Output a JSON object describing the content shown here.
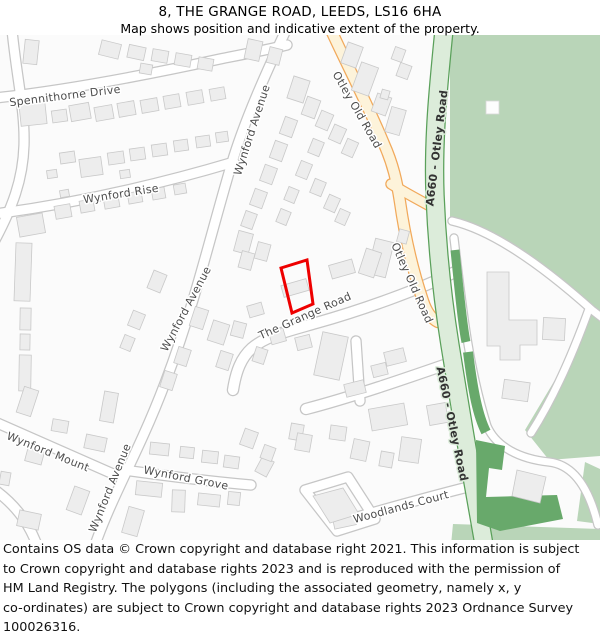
{
  "title": {
    "line1": "8, THE GRANGE ROAD, LEEDS, LS16 6HA",
    "line2": "Map shows position and indicative extent of the property."
  },
  "footer": {
    "lines": [
      "Contains OS data © Crown copyright and database right 2021. This information is subject",
      "to Crown copyright and database rights 2023 and is reproduced with the permission of",
      "HM Land Registry. The polygons (including the associated geometry, namely x, y",
      "co-ordinates) are subject to Crown copyright and database rights 2023 Ordnance Survey",
      "100026316."
    ]
  },
  "map": {
    "colors": {
      "bg": "#fbfbfb",
      "building_fill": "#ededed",
      "building_stroke": "#c9c9c9",
      "road_casing": "#c6c6c6",
      "road_fill": "#ffffff",
      "yellow_road_fill": "#fdf3da",
      "yellow_road_casing": "#f1a95b",
      "green_road_fill": "#dcecda",
      "green_road_casing": "#5aa05a",
      "green_light": "#b9d5b8",
      "green_dark": "#68a96b",
      "label_color": "#4c4c4c",
      "a_road_label_color": "#333333",
      "plot_color": "#ee0000",
      "white_building_fill": "#fdfdfd"
    },
    "green_light_areas": [
      "450,35 600,35 600,316 588,306 552,274 518,248 488,230 450,218",
      "590,312 600,322 600,456 549,460 525,430 571,353",
      "453,524 600,529 600,545 451,545",
      "585,462 600,469 600,524 577,521"
    ],
    "dark_green_paths": [
      {
        "d": "M 455,250 C 460,300 463,328 466,342",
        "w": 9
      },
      {
        "d": "M 468,352 C 473,392 478,416 486,432",
        "w": 10
      }
    ],
    "dark_green_polys": [
      "476,440 505,446 502,470 489,468 486,497 557,495 563,519 500,531 477,523"
    ],
    "roads": [
      {
        "d": "M 12,30 C 17,80 25,110 24,145 C 23,180 12,208 -5,240",
        "w": 9,
        "layer": "minor"
      },
      {
        "d": "M -5,98 C 70,90 160,72 220,59 C 245,54 266,50 287,45",
        "w": 9,
        "layer": "minor"
      },
      {
        "d": "M 286,30 C 265,75 246,118 234,156 C 221,198 208,250 193,300 C 179,347 163,392 143,436 C 125,476 108,508 95,545",
        "w": 9,
        "layer": "minor"
      },
      {
        "d": "M -5,214 C 70,204 150,187 234,162",
        "w": 9,
        "layer": "minor"
      },
      {
        "d": "M 233,390 C 236,371 241,358 252,348 C 266,336 288,331 316,323 C 366,309 420,289 455,272",
        "w": 10,
        "layer": "minor"
      },
      {
        "d": "M 306,409 C 352,397 404,379 453,362",
        "w": 10,
        "layer": "minor"
      },
      {
        "d": "M 356,341 L 360,401",
        "w": 9,
        "layer": "minor"
      },
      {
        "d": "M -5,422 C 40,442 85,462 120,477",
        "w": 9,
        "layer": "minor"
      },
      {
        "d": "M 124,470 C 160,475 205,481 251,485",
        "w": 9,
        "layer": "minor"
      },
      {
        "d": "M 332,524 C 372,513 420,499 468,487",
        "w": 9,
        "layer": "minor"
      },
      {
        "d": "M 305,490 L 348,477 L 375,519 L 337,531 Z",
        "w": 9,
        "layer": "minor"
      },
      {
        "d": "M -5,490 C 14,504 28,521 37,545",
        "w": 9,
        "layer": "minor"
      },
      {
        "d": "M 452,221 C 495,231 545,268 592,310 L 605,320",
        "w": 7,
        "layer": "minor"
      },
      {
        "d": "M 454,238 C 462,305 468,365 487,426 C 496,447 520,459 549,462 C 576,465 590,492 598,525",
        "w": 7,
        "layer": "minor"
      },
      {
        "d": "M 589,309 C 576,345 556,394 531,433",
        "w": 7,
        "layer": "minor"
      },
      {
        "d": "M 331,30 C 347,65 368,105 384,144 C 393,164 397,182 400,202 C 405,237 413,271 423,301 C 427,313 432,319 438,322",
        "w": 10,
        "layer": "yellow"
      },
      {
        "d": "M 391,184 C 404,192 417,199 430,206",
        "w": 9,
        "layer": "yellow"
      },
      {
        "d": "M 444,30 C 438,90 433,140 435,195 C 437,245 442,295 450,345 C 457,388 465,438 474,488 C 478,510 481,527 484,545",
        "w": 17,
        "layer": "green"
      }
    ],
    "buildings": [
      [
        24,
        40,
        14,
        24,
        6
      ],
      [
        100,
        42,
        20,
        15,
        14
      ],
      [
        128,
        46,
        17,
        13,
        12
      ],
      [
        152,
        50,
        16,
        12,
        10
      ],
      [
        175,
        54,
        16,
        12,
        10
      ],
      [
        198,
        58,
        15,
        12,
        10
      ],
      [
        140,
        64,
        12,
        10,
        10
      ],
      [
        246,
        40,
        15,
        20,
        12
      ],
      [
        268,
        48,
        13,
        16,
        14
      ],
      [
        20,
        103,
        26,
        22,
        -6
      ],
      [
        52,
        110,
        15,
        12,
        -8
      ],
      [
        70,
        104,
        20,
        16,
        -10
      ],
      [
        95,
        106,
        18,
        14,
        -10
      ],
      [
        118,
        102,
        17,
        14,
        -10
      ],
      [
        141,
        99,
        17,
        13,
        -10
      ],
      [
        164,
        95,
        16,
        13,
        -10
      ],
      [
        187,
        91,
        16,
        13,
        -10
      ],
      [
        210,
        88,
        15,
        12,
        -10
      ],
      [
        60,
        152,
        15,
        11,
        -8
      ],
      [
        47,
        170,
        10,
        8,
        -8
      ],
      [
        80,
        158,
        22,
        18,
        -8
      ],
      [
        108,
        152,
        16,
        12,
        -8
      ],
      [
        130,
        148,
        15,
        12,
        -8
      ],
      [
        152,
        144,
        15,
        12,
        -8
      ],
      [
        174,
        140,
        14,
        11,
        -8
      ],
      [
        196,
        136,
        14,
        11,
        -8
      ],
      [
        216,
        132,
        12,
        10,
        -8
      ],
      [
        120,
        170,
        10,
        8,
        -8
      ],
      [
        18,
        215,
        26,
        20,
        -10
      ],
      [
        55,
        205,
        16,
        13,
        -10
      ],
      [
        80,
        200,
        14,
        12,
        -10
      ],
      [
        104,
        196,
        15,
        12,
        -10
      ],
      [
        128,
        192,
        14,
        11,
        -10
      ],
      [
        152,
        188,
        13,
        11,
        -10
      ],
      [
        174,
        184,
        12,
        10,
        -10
      ],
      [
        60,
        190,
        9,
        7,
        -10
      ],
      [
        15,
        243,
        16,
        58,
        2
      ],
      [
        20,
        308,
        11,
        22,
        1
      ],
      [
        20,
        334,
        10,
        16,
        1
      ],
      [
        19,
        355,
        12,
        36,
        1
      ],
      [
        150,
        272,
        14,
        19,
        22
      ],
      [
        130,
        312,
        13,
        16,
        22
      ],
      [
        122,
        336,
        11,
        14,
        22
      ],
      [
        192,
        308,
        14,
        20,
        18
      ],
      [
        210,
        322,
        17,
        21,
        18
      ],
      [
        218,
        352,
        13,
        17,
        18
      ],
      [
        176,
        348,
        13,
        17,
        18
      ],
      [
        162,
        372,
        13,
        17,
        18
      ],
      [
        290,
        78,
        17,
        23,
        18
      ],
      [
        304,
        98,
        14,
        19,
        20
      ],
      [
        282,
        118,
        13,
        18,
        20
      ],
      [
        272,
        142,
        13,
        18,
        20
      ],
      [
        262,
        166,
        13,
        17,
        20
      ],
      [
        252,
        190,
        13,
        17,
        20
      ],
      [
        243,
        212,
        12,
        16,
        20
      ],
      [
        318,
        112,
        13,
        17,
        23
      ],
      [
        331,
        126,
        13,
        16,
        24
      ],
      [
        344,
        140,
        12,
        16,
        24
      ],
      [
        310,
        140,
        12,
        15,
        22
      ],
      [
        298,
        162,
        12,
        16,
        22
      ],
      [
        312,
        180,
        12,
        15,
        22
      ],
      [
        326,
        196,
        12,
        15,
        24
      ],
      [
        337,
        210,
        11,
        14,
        24
      ],
      [
        286,
        188,
        11,
        14,
        22
      ],
      [
        278,
        210,
        11,
        14,
        22
      ],
      [
        344,
        44,
        16,
        22,
        20
      ],
      [
        356,
        64,
        18,
        30,
        20
      ],
      [
        374,
        95,
        15,
        19,
        20
      ],
      [
        393,
        48,
        11,
        13,
        20
      ],
      [
        398,
        64,
        12,
        14,
        20
      ],
      [
        388,
        108,
        15,
        26,
        16
      ],
      [
        381,
        90,
        8,
        9,
        16
      ],
      [
        371,
        240,
        19,
        36,
        14
      ],
      [
        398,
        230,
        10,
        13,
        15
      ],
      [
        236,
        232,
        15,
        21,
        15
      ],
      [
        256,
        243,
        13,
        17,
        15
      ],
      [
        330,
        262,
        24,
        14,
        -16
      ],
      [
        362,
        250,
        16,
        26,
        18
      ],
      [
        282,
        282,
        26,
        12,
        -16
      ],
      [
        240,
        252,
        13,
        17,
        15
      ],
      [
        248,
        304,
        15,
        12,
        -16
      ],
      [
        232,
        322,
        13,
        15,
        15
      ],
      [
        270,
        330,
        15,
        13,
        -16
      ],
      [
        318,
        334,
        26,
        44,
        12
      ],
      [
        296,
        336,
        15,
        13,
        -14
      ],
      [
        254,
        348,
        12,
        15,
        18
      ],
      [
        290,
        424,
        13,
        16,
        10
      ],
      [
        345,
        382,
        20,
        13,
        -14
      ],
      [
        372,
        364,
        15,
        12,
        -14
      ],
      [
        385,
        350,
        20,
        14,
        -14
      ],
      [
        370,
        406,
        36,
        22,
        -10
      ],
      [
        428,
        404,
        19,
        20,
        -10
      ],
      [
        20,
        388,
        15,
        27,
        18
      ],
      [
        52,
        420,
        16,
        12,
        10
      ],
      [
        85,
        436,
        21,
        14,
        12
      ],
      [
        26,
        450,
        17,
        13,
        15
      ],
      [
        70,
        488,
        16,
        25,
        20
      ],
      [
        18,
        512,
        22,
        16,
        12
      ],
      [
        0,
        472,
        10,
        13,
        10
      ],
      [
        102,
        392,
        14,
        30,
        10
      ],
      [
        150,
        443,
        19,
        12,
        6
      ],
      [
        180,
        447,
        14,
        11,
        6
      ],
      [
        202,
        451,
        16,
        12,
        6
      ],
      [
        224,
        456,
        15,
        12,
        8
      ],
      [
        258,
        458,
        13,
        17,
        28
      ],
      [
        136,
        482,
        26,
        14,
        6
      ],
      [
        172,
        490,
        13,
        22,
        2
      ],
      [
        198,
        494,
        22,
        12,
        6
      ],
      [
        228,
        492,
        12,
        13,
        6
      ],
      [
        125,
        508,
        16,
        27,
        16
      ],
      [
        242,
        430,
        14,
        17,
        20
      ],
      [
        262,
        446,
        12,
        14,
        20
      ],
      [
        296,
        434,
        15,
        17,
        10
      ],
      [
        330,
        426,
        16,
        14,
        8
      ],
      [
        352,
        440,
        16,
        20,
        12
      ],
      [
        380,
        452,
        13,
        15,
        10
      ],
      [
        400,
        438,
        20,
        24,
        8
      ],
      [
        333,
        512,
        22,
        15,
        -12
      ],
      [
        503,
        381,
        26,
        19,
        8
      ],
      [
        543,
        318,
        22,
        22,
        3
      ]
    ],
    "building_polys": [
      "487,272 509,272 509,320 537,320 537,345 520,345 520,360 500,360 500,346 487,346",
      "313,496 343,488 359,514 330,523",
      "517,470 546,477 540,503 512,496"
    ],
    "white_buildings": [
      [
        486,
        101,
        13,
        13
      ]
    ],
    "plot": {
      "points": "281,268 307,260 313,304 292,313",
      "stroke_width": 3
    },
    "labels": [
      {
        "t": "Spennithorne Drive",
        "x": 65,
        "y": 96,
        "r": -7,
        "b": false
      },
      {
        "t": "Wynford Avenue",
        "x": 252,
        "y": 130,
        "r": -72,
        "b": false
      },
      {
        "t": "Wynford Rise",
        "x": 121,
        "y": 194,
        "r": -9,
        "b": false
      },
      {
        "t": "Wynford Avenue",
        "x": 186,
        "y": 309,
        "r": -62,
        "b": false
      },
      {
        "t": "Wynford Avenue",
        "x": 110,
        "y": 488,
        "r": -68,
        "b": false
      },
      {
        "t": "Wynford Mount",
        "x": 48,
        "y": 452,
        "r": 22,
        "b": false
      },
      {
        "t": "Wynford Grove",
        "x": 186,
        "y": 478,
        "r": 11,
        "b": false
      },
      {
        "t": "The Grange Road",
        "x": 305,
        "y": 316,
        "r": -24,
        "b": false
      },
      {
        "t": "Woodlands Court",
        "x": 401,
        "y": 507,
        "r": -15,
        "b": false
      },
      {
        "t": "Otley Old Road",
        "x": 357,
        "y": 110,
        "r": 60,
        "b": false
      },
      {
        "t": "Otley Old Road",
        "x": 412,
        "y": 283,
        "r": 66,
        "b": false
      },
      {
        "t": "A660 - Otley Road",
        "x": 437,
        "y": 148,
        "r": -83,
        "b": true
      },
      {
        "t": "A660 - Otley Road",
        "x": 452,
        "y": 424,
        "r": 78,
        "b": true
      }
    ]
  }
}
